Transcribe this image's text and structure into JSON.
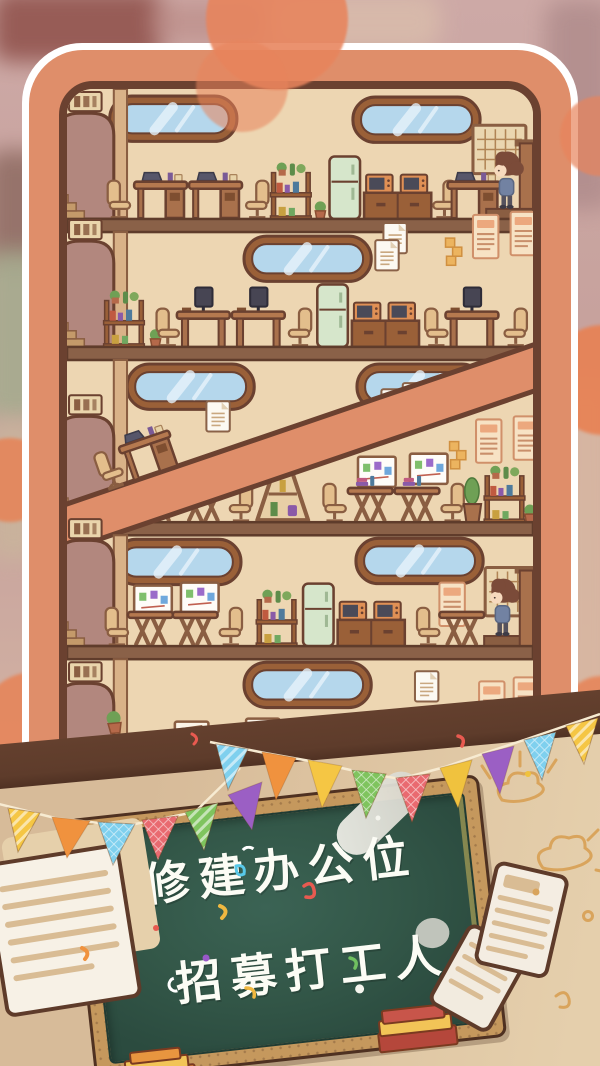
{
  "game": {
    "scene": "office-building-cross-section",
    "chalkboard": {
      "line1": "修建办公位",
      "line2": "招募打工人"
    }
  },
  "building": {
    "floors": [
      {
        "name": "floor-5-top",
        "items": [
          "arched-door-with-stairs",
          "door-sign",
          "window",
          "window",
          "office-chair",
          "desk-with-laptop",
          "desk-with-laptop",
          "plant-shelf",
          "potted-plant",
          "fridge",
          "cabinet-with-two-monitors",
          "desk",
          "worker-character",
          "go-board",
          "platform"
        ]
      },
      {
        "name": "floor-4",
        "items": [
          "arched-door-with-stairs",
          "door-sign",
          "window",
          "plant-shelf",
          "monitor-desk",
          "monitor-desk",
          "office-chair",
          "fridge",
          "cabinet-with-two-monitors",
          "monitor-desk",
          "monitor-desk",
          "wall-posters",
          "documents",
          "sticky-notes"
        ]
      },
      {
        "name": "floor-3",
        "items": [
          "arched-door-with-stairs",
          "door-sign",
          "window",
          "window",
          "diagonal-ramp",
          "desk-on-ramp",
          "picnic-table",
          "picnic-table",
          "triangle-shelf",
          "picnic-table",
          "picnic-table",
          "whiteboard-diagram",
          "whiteboard-diagram",
          "wall-posters",
          "cactus-plant",
          "plant-shelf"
        ]
      },
      {
        "name": "floor-2",
        "items": [
          "arched-door-with-stairs",
          "door-sign",
          "window",
          "window",
          "whiteboard-diagram",
          "whiteboard-diagram",
          "picnic-table",
          "picnic-table",
          "plant-shelf",
          "fridge",
          "cabinet-with-two-monitors",
          "picnic-table",
          "worker-character",
          "go-board",
          "wall-poster"
        ]
      },
      {
        "name": "floor-1-bottom",
        "items": [
          "arched-door-with-stairs",
          "door-sign",
          "window",
          "documents",
          "wall-posters",
          "framed-bar-chart",
          "framed-line-chart",
          "framed-chart",
          "potted-plant"
        ]
      }
    ]
  },
  "decorations": {
    "flag_colors": [
      "#F5C644",
      "#F0923E",
      "#7FD0EE",
      "#E96A70",
      "#7FC45E",
      "#9B5FC4",
      "#7FD0EE",
      "#F0923E",
      "#F5C644",
      "#7FC45E",
      "#E96A70",
      "#F0C23E",
      "#9B5FC4",
      "#7FD0EE",
      "#F5C644"
    ],
    "confetti_colors": [
      "#E85A50",
      "#F0B840",
      "#58C8E8",
      "#70C060",
      "#9858C8",
      "#F0923E"
    ],
    "doodle_color": "#D9A45C"
  },
  "colors": {
    "frame": "#DF8E6A",
    "frame_border": "#6B4130",
    "frame_outline": "#FFFFFF",
    "wall": "#EDD6B2",
    "floor_slab": "#8A6148",
    "beam": "#5E3C2B",
    "window_glass": "#B5D7EC",
    "fridge": "#D6E6CB",
    "chalkboard_green": "#335748",
    "chalkboard_frame": "#C5985D",
    "lower_wall": "#DCC09E",
    "background": "#C9A6A2",
    "accent_circle": "#E88153"
  }
}
